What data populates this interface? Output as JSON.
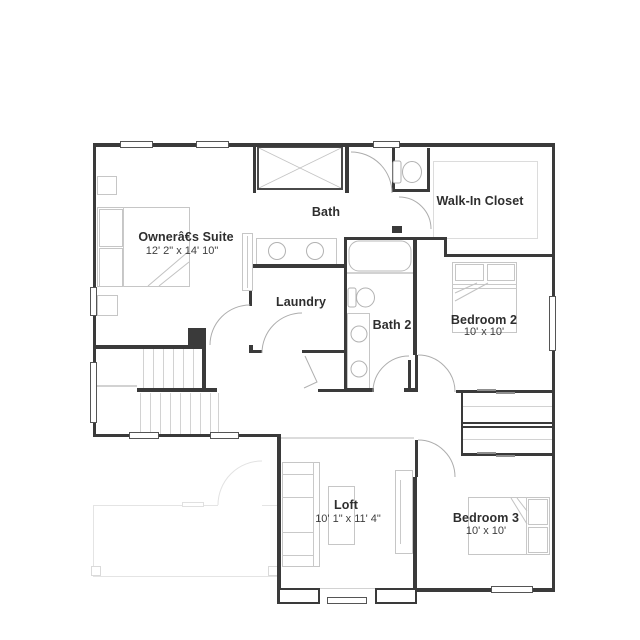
{
  "rooms": [
    {
      "name": "Ownerâ€͸s Suite",
      "dims": "12' 2\" x 14' 10\""
    },
    {
      "name": "Bath"
    },
    {
      "name": "Walk-In Closet"
    },
    {
      "name": "Laundry"
    },
    {
      "name": "Bath 2"
    },
    {
      "name": "Bedroom 2",
      "dims": "10' x 10'"
    },
    {
      "name": "Loft",
      "dims": "10' 1\" x 11' 4\""
    },
    {
      "name": "Bedroom 3",
      "dims": "10' x 10'"
    }
  ],
  "colors": {
    "wall": "#3a3a3a",
    "fixture": "#b3b3b3",
    "furniture": "#c7c7c7",
    "faint": "#e4e4e4",
    "label": "#2e2e2e"
  }
}
